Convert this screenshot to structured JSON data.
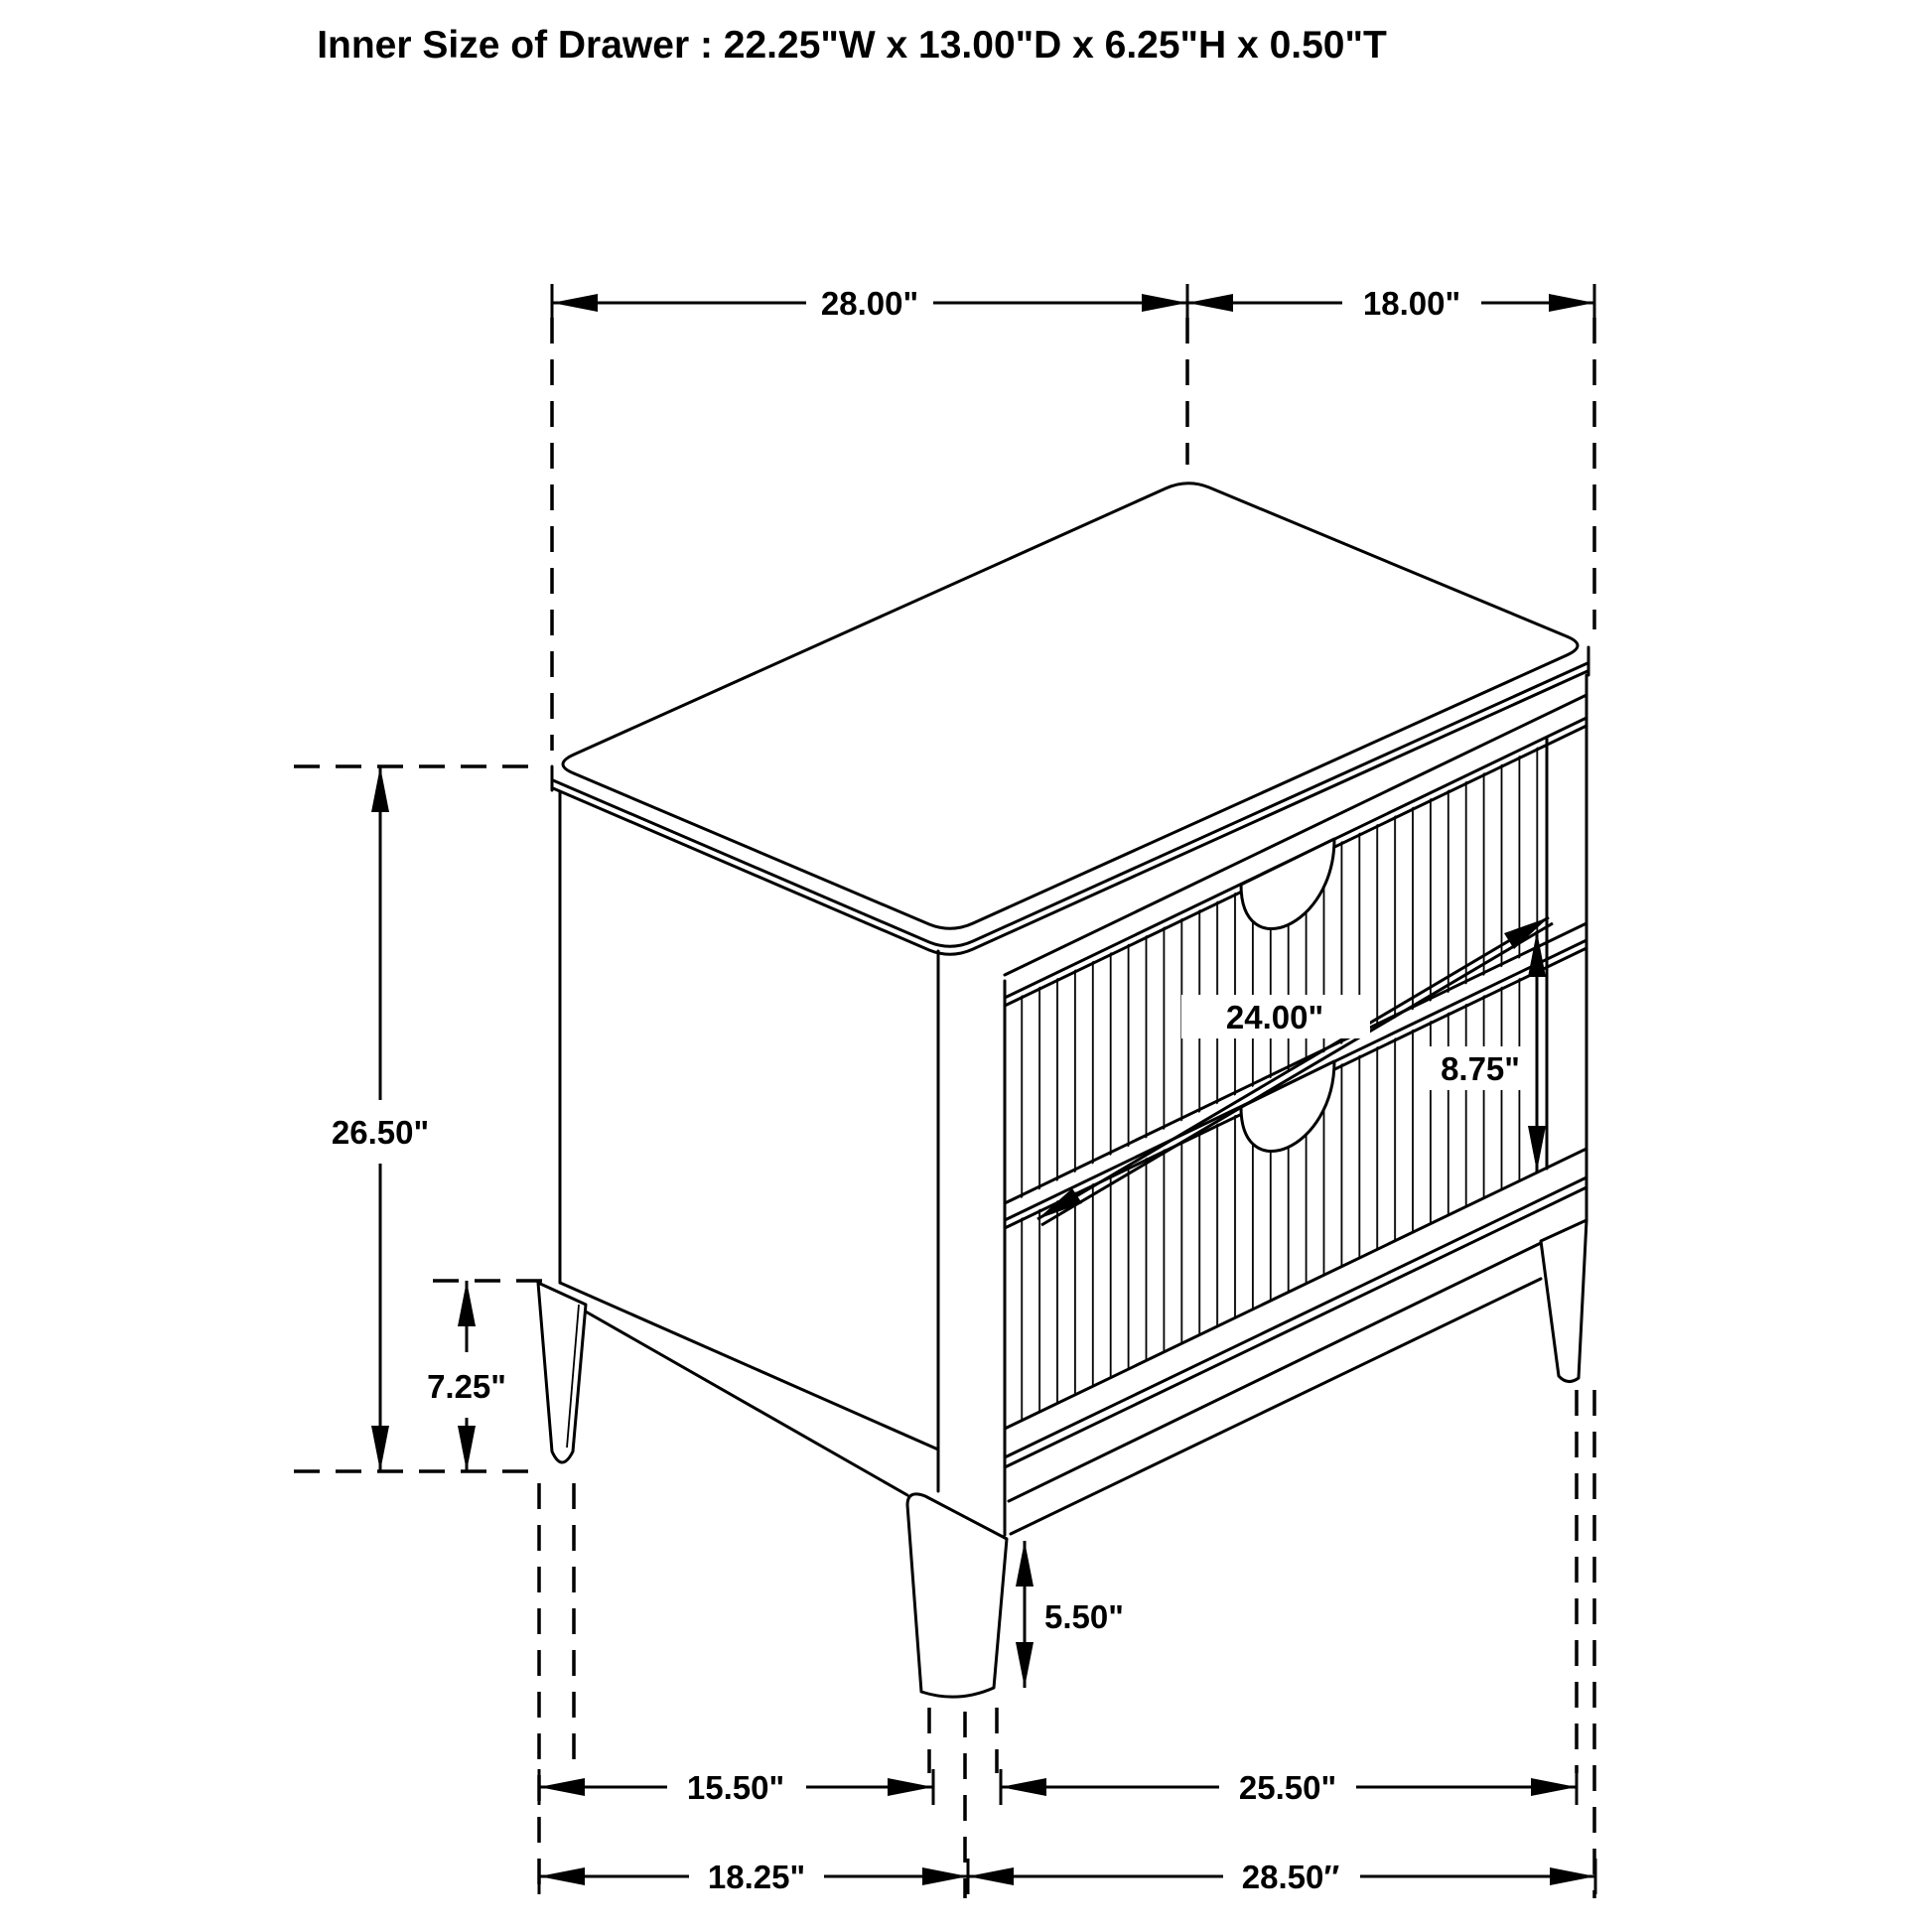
{
  "title": "Inner Size of Drawer : 22.25\"W x 13.00\"D x 6.25\"H x 0.50\"T",
  "dims": {
    "top_width": "28.00\"",
    "top_depth": "18.00\"",
    "total_height": "26.50\"",
    "side_leg_height": "7.25\"",
    "drawer_width": "24.00\"",
    "drawer_front_height": "8.75\"",
    "front_leg_height": "5.50\"",
    "feet_gap_side": "15.50\"",
    "feet_gap_front": "25.50\"",
    "base_depth": "18.25\"",
    "base_width": "28.50″"
  },
  "colors": {
    "line": "#000000",
    "background": "#ffffff"
  }
}
